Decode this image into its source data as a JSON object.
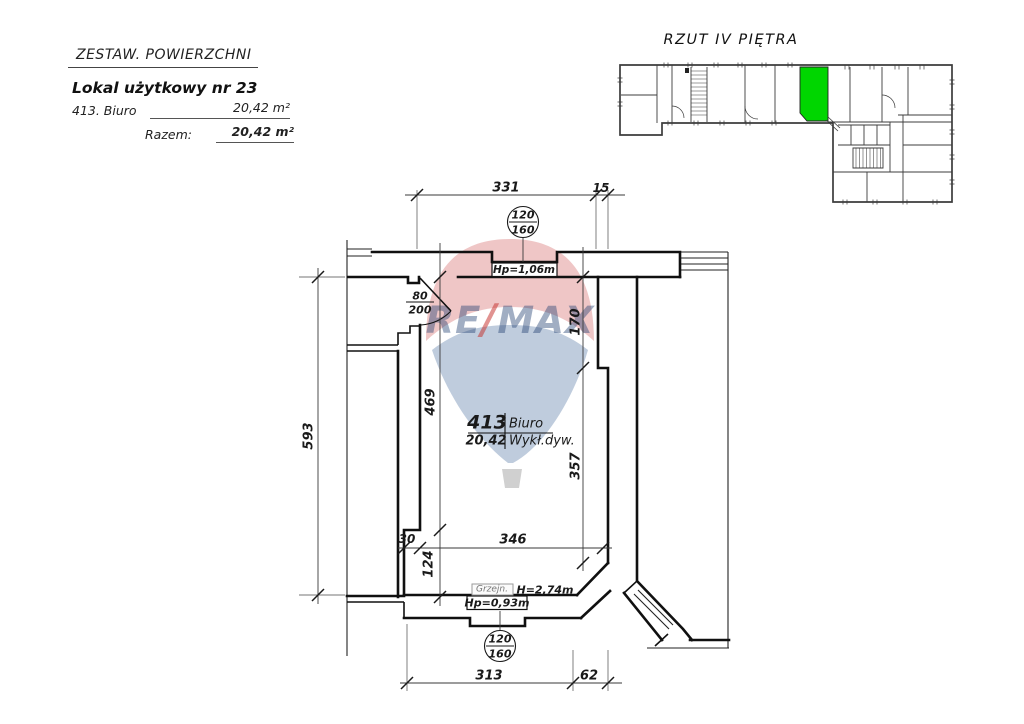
{
  "header": {
    "title": "ZESTAW. POWIERZCHNI",
    "subtitle": "Lokal użytkowy nr 23",
    "row_label": "413. Biuro",
    "row_value": "20,42 m²",
    "total_label": "Razem:",
    "total_value": "20,42 m²"
  },
  "overview": {
    "title": "RZUT IV PIĘTRA",
    "highlight_color": "#00d600"
  },
  "watermark": {
    "re": "RE",
    "slash": "/",
    "max": "MAX",
    "blue": "#20459c",
    "red": "#c6302c"
  },
  "room_label": {
    "number": "413",
    "name": "Biuro",
    "area": "20,42",
    "finish": "Wykł.dyw."
  },
  "annotations": {
    "window_top_sill": "Hp=1,06m",
    "window_bottom_sill": "Hp=0,93m",
    "room_height": "H=2,74m",
    "radiator": "Grzejn.",
    "door_width": "80",
    "door_height": "200",
    "window_width": "120",
    "window_height": "160"
  },
  "dims": {
    "top_main": "331",
    "top_side": "15",
    "left_total": "593",
    "left_inner": "469",
    "left_lower": "124",
    "step": "30",
    "right_upper": "170",
    "right_lower": "357",
    "bottom_inner": "346",
    "bottom_main": "313",
    "bottom_side": "62"
  }
}
